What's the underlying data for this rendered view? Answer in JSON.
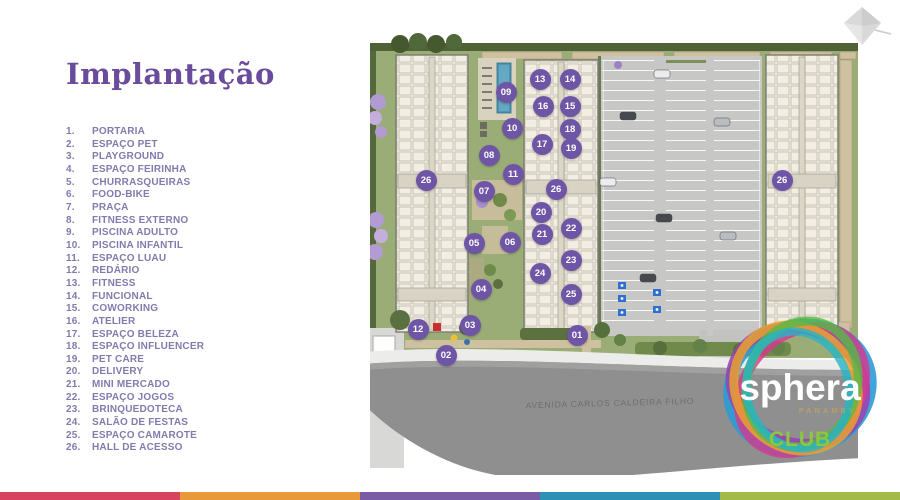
{
  "slide": {
    "title": "Implantação",
    "title_color": "#6a4b9c"
  },
  "legend": {
    "text_color": "#837aae",
    "items": [
      {
        "n": "1.",
        "label": "PORTARIA"
      },
      {
        "n": "2.",
        "label": "ESPAÇO PET"
      },
      {
        "n": "3.",
        "label": "PLAYGROUND"
      },
      {
        "n": "4.",
        "label": "ESPAÇO FEIRINHA"
      },
      {
        "n": "5.",
        "label": "CHURRASQUEIRAS"
      },
      {
        "n": "6.",
        "label": "FOOD-BIKE"
      },
      {
        "n": "7.",
        "label": "PRAÇA"
      },
      {
        "n": "8.",
        "label": "FITNESS EXTERNO"
      },
      {
        "n": "9.",
        "label": "PISCINA ADULTO"
      },
      {
        "n": "10.",
        "label": "PISCINA INFANTIL"
      },
      {
        "n": "11.",
        "label": "ESPAÇO LUAU"
      },
      {
        "n": "12.",
        "label": "REDÁRIO"
      },
      {
        "n": "13.",
        "label": "FITNESS"
      },
      {
        "n": "14.",
        "label": "FUNCIONAL"
      },
      {
        "n": "15.",
        "label": "COWORKING"
      },
      {
        "n": "16.",
        "label": "ATELIER"
      },
      {
        "n": "17.",
        "label": "ESPAÇO BELEZA"
      },
      {
        "n": "18.",
        "label": "ESPAÇO INFLUENCER"
      },
      {
        "n": "19.",
        "label": "PET CARE"
      },
      {
        "n": "20.",
        "label": "DELIVERY"
      },
      {
        "n": "21.",
        "label": "MINI MERCADO"
      },
      {
        "n": "22.",
        "label": "ESPAÇO JOGOS"
      },
      {
        "n": "23.",
        "label": "BRINQUEDOTECA"
      },
      {
        "n": "24.",
        "label": "SALÃO DE FESTAS"
      },
      {
        "n": "25.",
        "label": "ESPAÇO CAMAROTE"
      },
      {
        "n": "26.",
        "label": "HALL DE ACESSO"
      }
    ]
  },
  "map": {
    "street_label": "AVENIDA CARLOS CALDEIRA FILHO",
    "marker_color": "#6f55a5",
    "markers": [
      {
        "n": "01",
        "x": 207,
        "y": 305
      },
      {
        "n": "02",
        "x": 76,
        "y": 325
      },
      {
        "n": "03",
        "x": 100,
        "y": 295
      },
      {
        "n": "04",
        "x": 111,
        "y": 259
      },
      {
        "n": "05",
        "x": 104,
        "y": 213
      },
      {
        "n": "06",
        "x": 140,
        "y": 212
      },
      {
        "n": "07",
        "x": 114,
        "y": 161
      },
      {
        "n": "08",
        "x": 119,
        "y": 125
      },
      {
        "n": "09",
        "x": 136,
        "y": 62
      },
      {
        "n": "10",
        "x": 142,
        "y": 98
      },
      {
        "n": "11",
        "x": 143,
        "y": 144
      },
      {
        "n": "12",
        "x": 48,
        "y": 299
      },
      {
        "n": "13",
        "x": 170,
        "y": 49
      },
      {
        "n": "14",
        "x": 200,
        "y": 49
      },
      {
        "n": "15",
        "x": 200,
        "y": 76
      },
      {
        "n": "16",
        "x": 173,
        "y": 76
      },
      {
        "n": "17",
        "x": 172,
        "y": 114
      },
      {
        "n": "18",
        "x": 200,
        "y": 99
      },
      {
        "n": "19",
        "x": 201,
        "y": 118
      },
      {
        "n": "20",
        "x": 171,
        "y": 182
      },
      {
        "n": "21",
        "x": 172,
        "y": 204
      },
      {
        "n": "22",
        "x": 201,
        "y": 198
      },
      {
        "n": "23",
        "x": 201,
        "y": 230
      },
      {
        "n": "24",
        "x": 170,
        "y": 243
      },
      {
        "n": "25",
        "x": 201,
        "y": 264
      },
      {
        "n": "26",
        "x": 56,
        "y": 150
      },
      {
        "n": "26",
        "x": 186,
        "y": 159
      },
      {
        "n": "26",
        "x": 412,
        "y": 150
      }
    ]
  },
  "logo": {
    "name": "sphera",
    "location": "PANAMBY",
    "club": "CLUB",
    "club_color": "#8dc63f"
  },
  "footer": {
    "stripe_colors": [
      "#d8435f",
      "#e89a3a",
      "#7a5ba5",
      "#2e90b5",
      "#a2ba48"
    ]
  }
}
